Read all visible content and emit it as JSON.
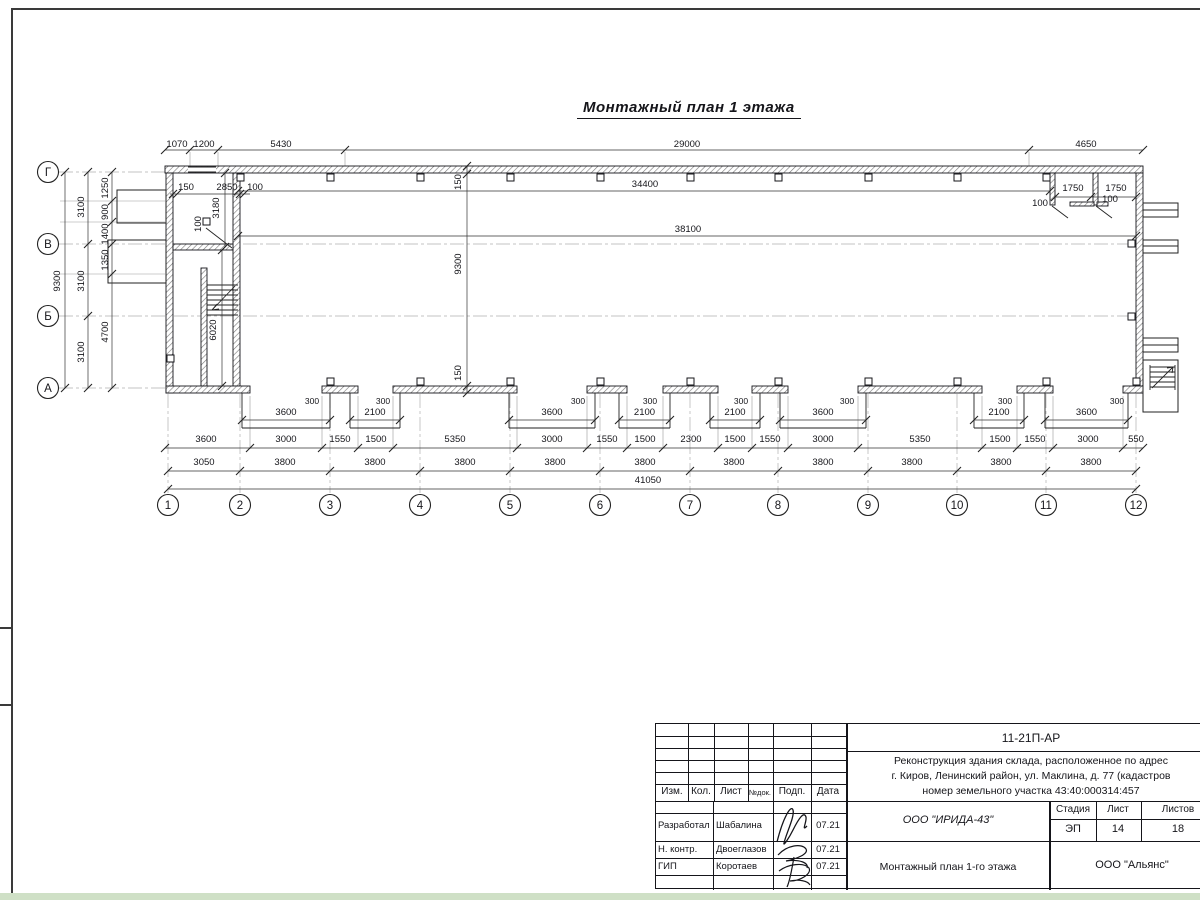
{
  "sheet": {
    "title": "Монтажный план 1 этажа"
  },
  "axes": {
    "cols": [
      {
        "n": "1",
        "x": 168
      },
      {
        "n": "2",
        "x": 240
      },
      {
        "n": "3",
        "x": 330
      },
      {
        "n": "4",
        "x": 420
      },
      {
        "n": "5",
        "x": 510
      },
      {
        "n": "6",
        "x": 600
      },
      {
        "n": "7",
        "x": 690
      },
      {
        "n": "8",
        "x": 778
      },
      {
        "n": "9",
        "x": 868
      },
      {
        "n": "10",
        "x": 957
      },
      {
        "n": "11",
        "x": 1046
      },
      {
        "n": "12",
        "x": 1136
      }
    ],
    "rows": [
      {
        "n": "Г",
        "y": 172,
        "x2": 165
      },
      {
        "n": "В",
        "y": 244,
        "x2": 1136
      },
      {
        "n": "Б",
        "y": 316,
        "x2": 1136
      },
      {
        "n": "А",
        "y": 388,
        "x2": 165
      }
    ]
  },
  "drawing": {
    "walls": [
      {
        "x": 165,
        "y": 166,
        "w": 978,
        "h": 7
      },
      {
        "x": 1136,
        "y": 173,
        "w": 7,
        "h": 220
      },
      {
        "x": 166,
        "y": 173,
        "w": 7,
        "h": 220
      },
      {
        "x": 233,
        "y": 173,
        "w": 7,
        "h": 213
      },
      {
        "x": 173,
        "y": 244,
        "w": 60,
        "h": 6
      },
      {
        "x": 201,
        "y": 268,
        "w": 6,
        "h": 118
      },
      {
        "x": 1050,
        "y": 173,
        "w": 5,
        "h": 32
      },
      {
        "x": 1093,
        "y": 173,
        "w": 5,
        "h": 32
      },
      {
        "x": 1070,
        "y": 202,
        "w": 24,
        "h": 4
      },
      {
        "x": 1097,
        "y": 202,
        "w": 11,
        "h": 4
      },
      {
        "x": 166,
        "y": 386,
        "w": 84,
        "h": 7
      },
      {
        "x": 322,
        "y": 386,
        "w": 36,
        "h": 7
      },
      {
        "x": 393,
        "y": 386,
        "w": 124,
        "h": 7
      },
      {
        "x": 587,
        "y": 386,
        "w": 40,
        "h": 7
      },
      {
        "x": 663,
        "y": 386,
        "w": 55,
        "h": 7
      },
      {
        "x": 752,
        "y": 386,
        "w": 36,
        "h": 7
      },
      {
        "x": 858,
        "y": 386,
        "w": 124,
        "h": 7
      },
      {
        "x": 1017,
        "y": 386,
        "w": 36,
        "h": 7
      },
      {
        "x": 1123,
        "y": 386,
        "w": 20,
        "h": 7
      }
    ],
    "thin_rects": [
      {
        "x": 117,
        "y": 190,
        "w": 49,
        "h": 33
      },
      {
        "x": 108,
        "y": 240,
        "w": 58,
        "h": 43
      },
      {
        "x": 1143,
        "y": 203,
        "w": 35,
        "h": 14
      },
      {
        "x": 1143,
        "y": 240,
        "w": 35,
        "h": 13
      },
      {
        "x": 1143,
        "y": 338,
        "w": 35,
        "h": 14
      },
      {
        "x": 1143,
        "y": 360,
        "w": 35,
        "h": 52
      },
      {
        "x": 188,
        "y": 167,
        "w": 28,
        "h": 5,
        "f": "#ffffff",
        "s": "none"
      }
    ],
    "lines": [
      [
        188,
        167,
        216,
        167
      ],
      [
        188,
        172,
        216,
        172
      ],
      [
        207,
        285,
        238,
        285
      ],
      [
        207,
        290,
        238,
        290
      ],
      [
        207,
        295,
        238,
        295
      ],
      [
        207,
        300,
        238,
        300
      ],
      [
        207,
        305,
        238,
        305
      ],
      [
        207,
        310,
        238,
        310
      ],
      [
        207,
        315,
        238,
        315
      ],
      [
        207,
        283,
        207,
        317
      ],
      [
        235,
        286,
        212,
        310
      ],
      [
        212,
        310,
        217,
        304
      ],
      [
        212,
        310,
        219,
        309
      ],
      [
        1150,
        367,
        1175,
        367
      ],
      [
        1150,
        372,
        1175,
        372
      ],
      [
        1150,
        377,
        1175,
        377
      ],
      [
        1150,
        382,
        1175,
        382
      ],
      [
        1150,
        387,
        1175,
        387
      ],
      [
        1150,
        365,
        1150,
        390
      ],
      [
        1175,
        365,
        1175,
        390
      ],
      [
        1152,
        388,
        1173,
        367
      ],
      [
        1173,
        367,
        1167,
        368
      ],
      [
        1173,
        367,
        1172,
        373
      ],
      [
        1052,
        206,
        1068,
        218
      ],
      [
        1096,
        206,
        1112,
        218
      ],
      [
        206,
        228,
        232,
        248
      ],
      [
        1143,
        210,
        1178,
        210
      ],
      [
        1143,
        246,
        1178,
        246
      ],
      [
        1143,
        345,
        1178,
        345
      ]
    ],
    "squares": [
      [
        237,
        174
      ],
      [
        327,
        174
      ],
      [
        417,
        174
      ],
      [
        507,
        174
      ],
      [
        597,
        174
      ],
      [
        687,
        174
      ],
      [
        775,
        174
      ],
      [
        865,
        174
      ],
      [
        954,
        174
      ],
      [
        1043,
        174
      ],
      [
        327,
        378
      ],
      [
        417,
        378
      ],
      [
        507,
        378
      ],
      [
        597,
        378
      ],
      [
        687,
        378
      ],
      [
        775,
        378
      ],
      [
        865,
        378
      ],
      [
        954,
        378
      ],
      [
        1043,
        378
      ],
      [
        1133,
        378
      ],
      [
        1128,
        240
      ],
      [
        1128,
        313
      ],
      [
        203,
        218
      ],
      [
        167,
        355
      ]
    ],
    "hdims": [
      {
        "y": 150,
        "x1": 165,
        "x2": 1143,
        "t": [
          165,
          190,
          218,
          345,
          1029,
          1143
        ]
      },
      {
        "y": 191,
        "x1": 238,
        "x2": 1050,
        "t": [
          238,
          1050
        ]
      },
      {
        "y": 236,
        "x1": 238,
        "x2": 1136,
        "t": [
          238,
          1136
        ]
      },
      {
        "y": 194,
        "x1": 170,
        "x2": 250,
        "t": [
          173,
          177,
          240,
          244
        ]
      },
      {
        "y": 197,
        "x1": 1055,
        "x2": 1136,
        "t": [
          1055,
          1091,
          1136
        ]
      },
      {
        "y": 448,
        "x1": 165,
        "x2": 1143,
        "t": [
          165,
          250,
          322,
          358,
          393,
          517,
          587,
          627,
          663,
          718,
          752,
          788,
          858,
          982,
          1017,
          1053,
          1123,
          1143
        ]
      },
      {
        "y": 471,
        "x1": 168,
        "x2": 1136,
        "t": [
          168,
          240,
          330,
          420,
          510,
          600,
          690,
          778,
          868,
          957,
          1046,
          1136
        ]
      },
      {
        "y": 489,
        "x1": 168,
        "x2": 1136,
        "t": [
          168,
          1136
        ]
      }
    ],
    "vdims": [
      {
        "x": 65,
        "y1": 172,
        "y2": 388,
        "t": [
          172,
          388
        ]
      },
      {
        "x": 88,
        "y1": 172,
        "y2": 388,
        "t": [
          172,
          244,
          316,
          388
        ]
      },
      {
        "x": 112,
        "y1": 172,
        "y2": 388,
        "t": [
          172,
          201,
          222,
          244,
          274,
          388
        ]
      },
      {
        "x": 225,
        "y1": 173,
        "y2": 247,
        "t": [
          173,
          247
        ]
      },
      {
        "x": 222,
        "y1": 250,
        "y2": 386,
        "t": [
          250,
          386
        ]
      },
      {
        "x": 467,
        "y1": 166,
        "y2": 393,
        "t": [
          166,
          174,
          386,
          393
        ]
      }
    ],
    "gates": [
      {
        "x1": 242,
        "x2": 330,
        "w": "3600",
        "tx": 312
      },
      {
        "x1": 350,
        "x2": 400,
        "w": "2100",
        "tx": 383
      },
      {
        "x1": 509,
        "x2": 595,
        "w": "3600",
        "tx": 578
      },
      {
        "x1": 619,
        "x2": 670,
        "w": "2100",
        "tx": 650
      },
      {
        "x1": 710,
        "x2": 760,
        "w": "2100",
        "tx": 741
      },
      {
        "x1": 780,
        "x2": 866,
        "w": "3600",
        "tx": 847
      },
      {
        "x1": 974,
        "x2": 1024,
        "w": "2100",
        "tx": 1005
      },
      {
        "x1": 1045,
        "x2": 1128,
        "w": "3600",
        "tx": 1117
      }
    ],
    "ext_v_top": [
      190,
      218,
      345,
      1029
    ],
    "ext_v_bottom": [
      250,
      322,
      358,
      393,
      517,
      587,
      627,
      663,
      718,
      752,
      788,
      858,
      982,
      1017,
      1053,
      1123
    ],
    "ext_h_left": [
      201,
      222,
      274
    ],
    "labels": [
      [
        177,
        147,
        "1070"
      ],
      [
        204,
        147,
        "1200"
      ],
      [
        281,
        147,
        "5430"
      ],
      [
        687,
        147,
        "29000"
      ],
      [
        1086,
        147,
        "4650"
      ],
      [
        645,
        187,
        "34400"
      ],
      [
        688,
        232,
        "38100"
      ],
      [
        186,
        190,
        "150"
      ],
      [
        227,
        190,
        "2850"
      ],
      [
        255,
        190,
        "100"
      ],
      [
        1073,
        191,
        "1750"
      ],
      [
        1116,
        191,
        "1750"
      ],
      [
        1040,
        206,
        "100"
      ],
      [
        1110,
        202,
        "100"
      ],
      [
        219,
        208,
        "3180",
        1
      ],
      [
        201,
        224,
        "100",
        1
      ],
      [
        216,
        330,
        "6020",
        1
      ],
      [
        461,
        182,
        "150",
        1
      ],
      [
        461,
        264,
        "9300",
        1
      ],
      [
        461,
        373,
        "150",
        1
      ],
      [
        60,
        281,
        "9300",
        1
      ],
      [
        84,
        207,
        "3100",
        1
      ],
      [
        84,
        281,
        "3100",
        1
      ],
      [
        84,
        352,
        "3100",
        1
      ],
      [
        108,
        188,
        "1250",
        1
      ],
      [
        108,
        212,
        "900",
        1
      ],
      [
        108,
        234,
        "1400",
        1
      ],
      [
        108,
        260,
        "1350",
        1
      ],
      [
        108,
        332,
        "4700",
        1
      ],
      [
        206,
        442,
        "3600"
      ],
      [
        286,
        442,
        "3000"
      ],
      [
        340,
        442,
        "1550"
      ],
      [
        376,
        442,
        "1500"
      ],
      [
        455,
        442,
        "5350"
      ],
      [
        552,
        442,
        "3000"
      ],
      [
        607,
        442,
        "1550"
      ],
      [
        645,
        442,
        "1500"
      ],
      [
        691,
        442,
        "2300"
      ],
      [
        735,
        442,
        "1500"
      ],
      [
        770,
        442,
        "1550"
      ],
      [
        823,
        442,
        "3000"
      ],
      [
        920,
        442,
        "5350"
      ],
      [
        1000,
        442,
        "1500"
      ],
      [
        1035,
        442,
        "1550"
      ],
      [
        1088,
        442,
        "3000"
      ],
      [
        1136,
        442,
        "550"
      ],
      [
        204,
        465,
        "3050"
      ],
      [
        285,
        465,
        "3800"
      ],
      [
        375,
        465,
        "3800"
      ],
      [
        465,
        465,
        "3800"
      ],
      [
        555,
        465,
        "3800"
      ],
      [
        645,
        465,
        "3800"
      ],
      [
        734,
        465,
        "3800"
      ],
      [
        823,
        465,
        "3800"
      ],
      [
        912,
        465,
        "3800"
      ],
      [
        1001,
        465,
        "3800"
      ],
      [
        1091,
        465,
        "3800"
      ],
      [
        648,
        483,
        "41050"
      ]
    ]
  },
  "titleblock": {
    "code": "11-21П-АР",
    "desc1": "Реконструкция здания склада, расположенное по адрес",
    "desc2": "г. Киров, Ленинский район, ул. Маклина, д. 77 (кадастров",
    "desc3": "номер земельного участка 43:40:000314:457",
    "cols": [
      "Изм.",
      "Кол.",
      "Лист",
      "№док.",
      "Подп.",
      "Дата"
    ],
    "rows": [
      {
        "role": "Разработал",
        "name": "Шабалина",
        "date": "07.21"
      },
      {
        "role": "Н. контр.",
        "name": "Двоеглазов",
        "date": "07.21"
      },
      {
        "role": "ГИП",
        "name": "Коротаев",
        "date": "07.21"
      }
    ],
    "org": "ООО \"ИРИДА-43\"",
    "stage_label": "Стадия",
    "sheet_label": "Лист",
    "sheets_label": "Листов",
    "stage": "ЭП",
    "sheet_no": "14",
    "sheets_total": "18",
    "plan_name": "Монтажный план 1-го этажа",
    "company": "ООО \"Альянс\""
  }
}
